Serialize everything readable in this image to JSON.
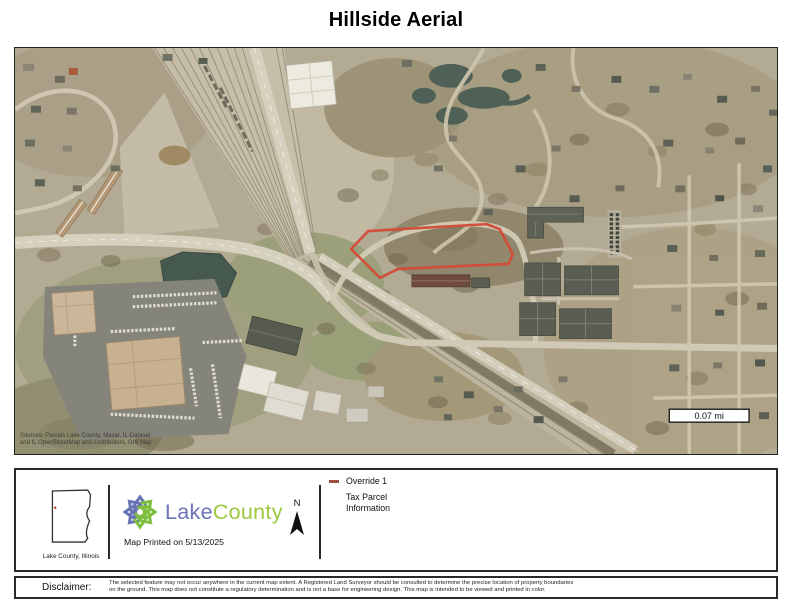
{
  "page": {
    "title": "Hillside Aerial"
  },
  "map": {
    "scale_label": "0.07 mi",
    "attribution_line1": "Sources: Parcels Lake County, Maxar, IL-Dataset",
    "attribution_line2": "and IL OpenStreetMap and contributors, GIS Map",
    "colors": {
      "parcel_outline": "#d44a38",
      "water": "#4f6156",
      "terrain_base": "#b2aa93"
    }
  },
  "footer": {
    "county_caption": "Lake County, Illinois",
    "logo_word1": "Lake",
    "logo_word2": "County",
    "logo_blue": "#6872b5",
    "logo_green": "#9cc941",
    "printed": "Map Printed on 5/13/2025",
    "north_label": "N",
    "legend_item1": "Override 1",
    "legend_item1_swatch": "#9e4f3d",
    "legend_item2": "Tax Parcel Information"
  },
  "disclaimer": {
    "label": "Disclaimer:",
    "line1": "The selected feature may not occur anywhere in the current map extent.  A Registered Land Surveyor should be consulted to determine the precise location of property boundaries",
    "line2": "on the ground.  This map does not constitute a regulatory determination and is not a base for engineering design.  This map is intended to be viewed and printed in color."
  }
}
